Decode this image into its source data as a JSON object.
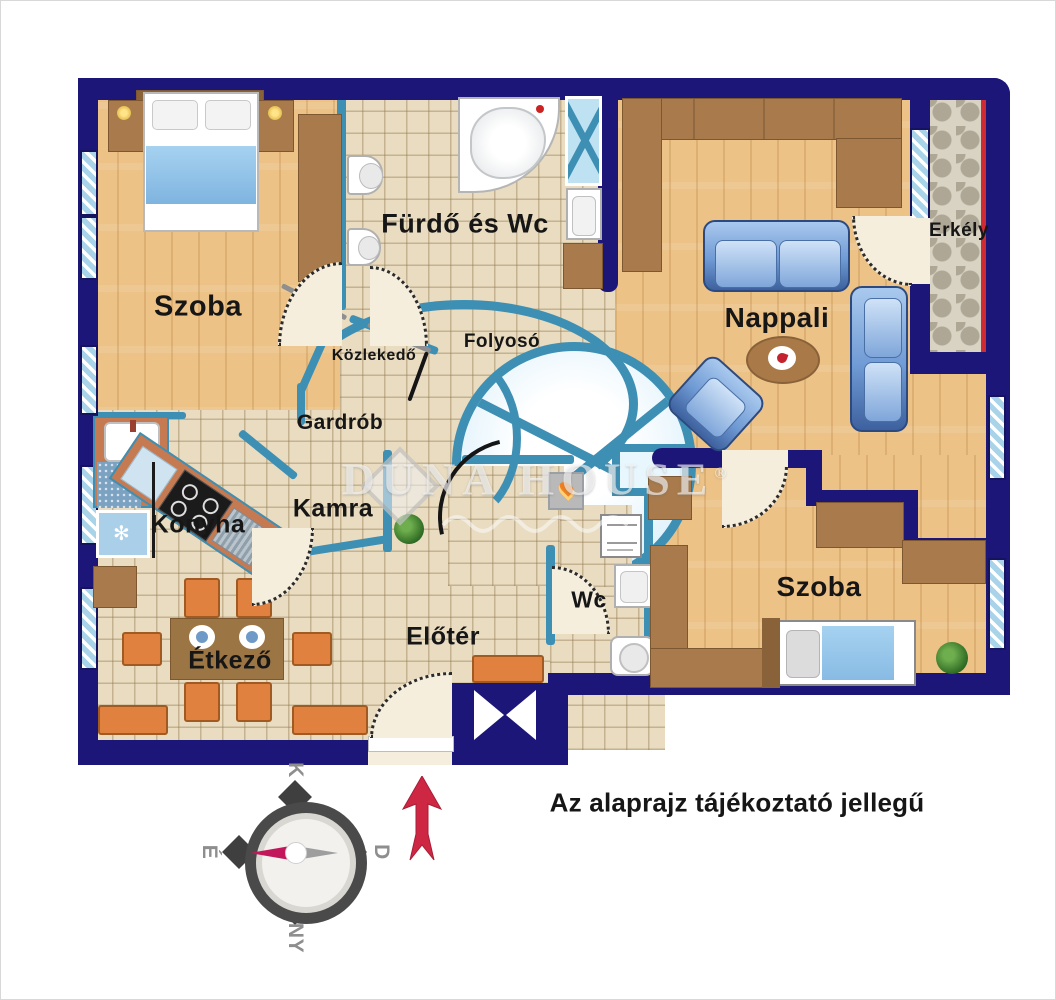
{
  "rooms": {
    "szoba1": "Szoba",
    "furdo": "Fürdő és Wc",
    "kozlekedo": "Közlekedő",
    "folyoso": "Folyosó",
    "gardrob": "Gardrób",
    "nappali": "Nappali",
    "erkely": "Erkély",
    "konyha": "Konyha",
    "kamra": "Kamra",
    "etkezo": "Étkező",
    "eloter": "Előtér",
    "wc": "Wc",
    "szoba2": "Szoba"
  },
  "watermark": {
    "brand": "DUNA HOUSE",
    "reg": "®"
  },
  "disclaimer": "Az alaprajz tájékoztató jellegű",
  "compass": {
    "top": "K",
    "right": "D",
    "bottom": "NY",
    "left": "É"
  },
  "colors": {
    "outer_wall": "#1c1678",
    "partition_wall": "#3e8fb4",
    "wood_floor": "#ecc287",
    "tile_floor": "#e9dcc0",
    "window": "#a9d3e8",
    "balcony_red": "#cf2b35",
    "furniture_brown": "#a87a4c",
    "sofa_blue": "#7ba7d9",
    "chair_orange": "#e0813f",
    "compass_arrow_red": "#cd2744"
  }
}
